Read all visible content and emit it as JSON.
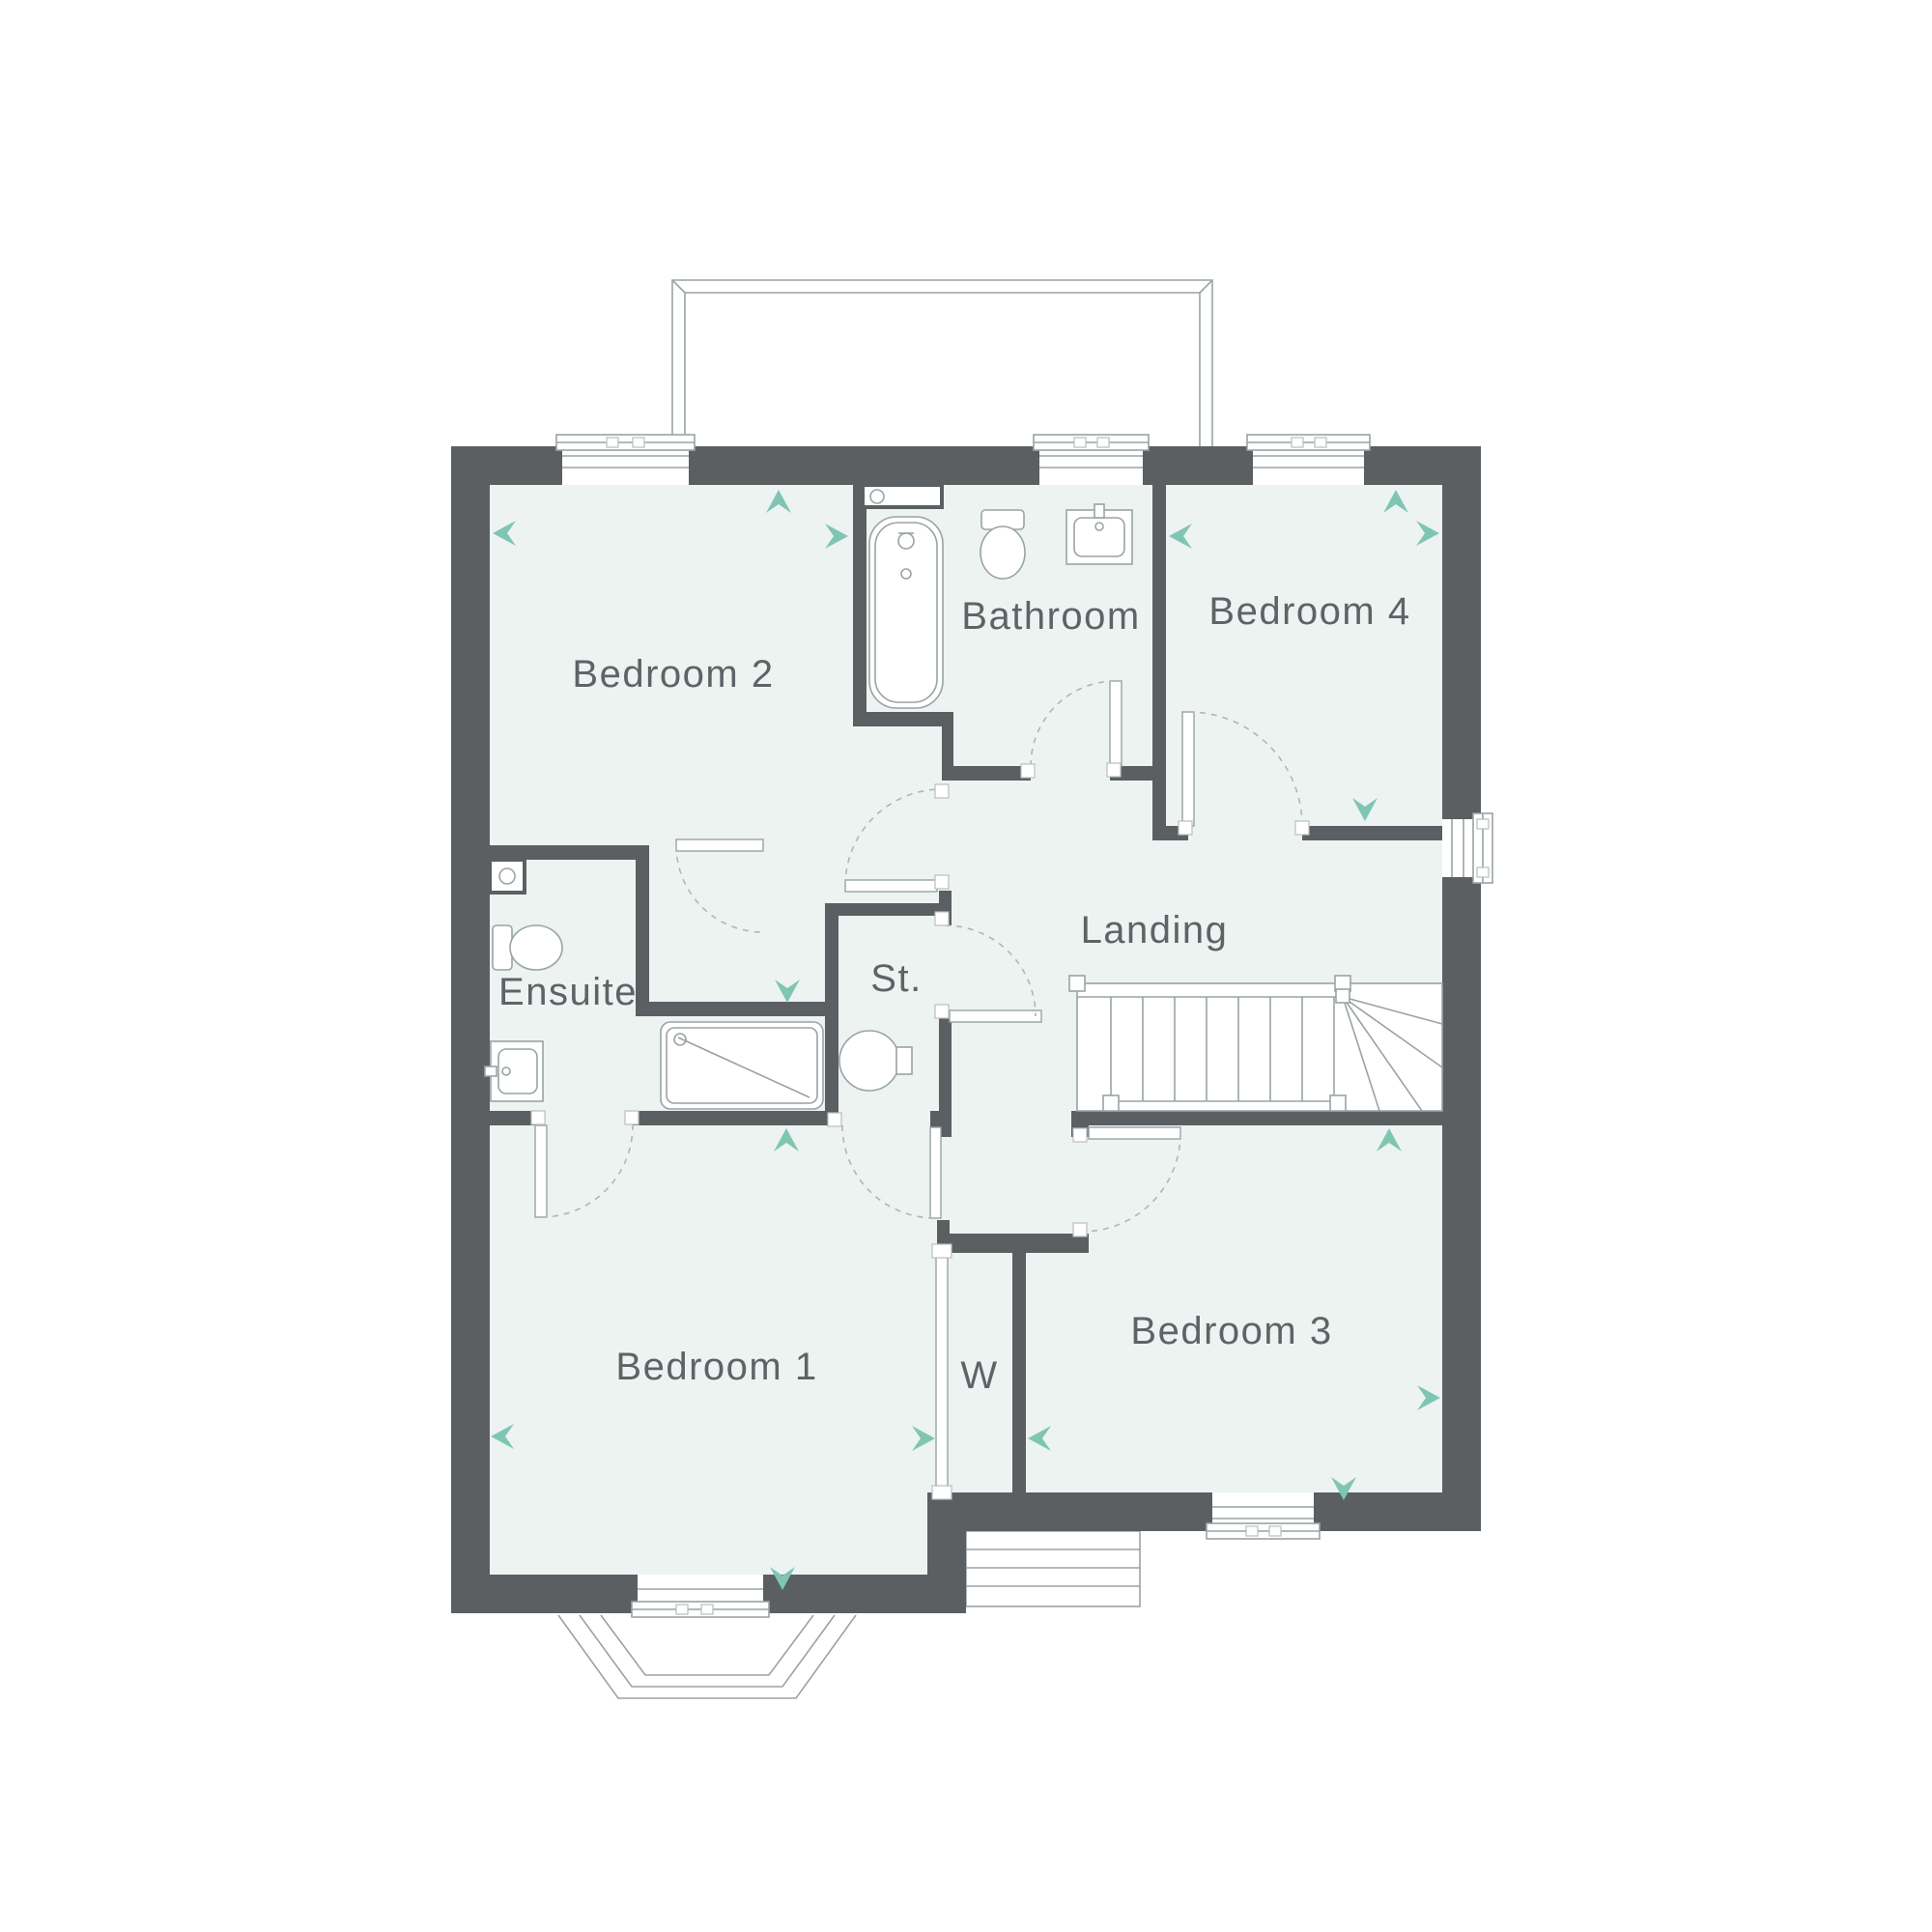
{
  "title": "First floor plan",
  "rooms": [
    {
      "id": "bedroom2",
      "label": "Bedroom 2"
    },
    {
      "id": "bathroom",
      "label": "Bathroom"
    },
    {
      "id": "bedroom4",
      "label": "Bedroom 4"
    },
    {
      "id": "ensuite",
      "label": "Ensuite"
    },
    {
      "id": "storage",
      "label": "St."
    },
    {
      "id": "landing",
      "label": "Landing"
    },
    {
      "id": "bedroom1",
      "label": "Bedroom 1"
    },
    {
      "id": "wardrobe",
      "label": "W"
    },
    {
      "id": "bedroom3",
      "label": "Bedroom 3"
    }
  ],
  "colors": {
    "wall": "#5b5f62",
    "room_fill": "#edf3f1",
    "outline_grey": "#9aa3a3",
    "arrow_teal": "#7fc6b2",
    "label_text": "#5d6366",
    "background": "#ffffff"
  }
}
